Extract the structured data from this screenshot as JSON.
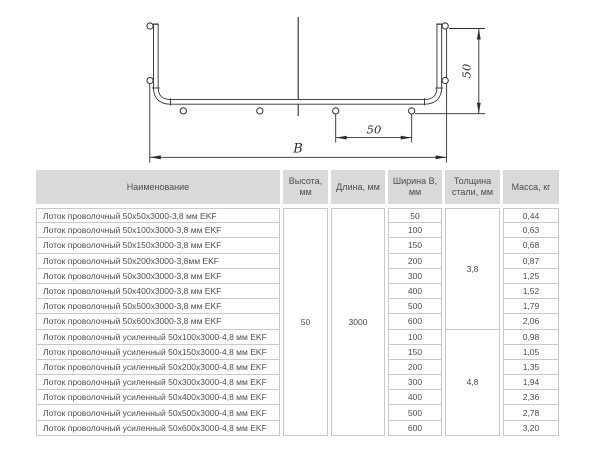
{
  "drawing": {
    "overall_width_label": "B",
    "side_height_dim": "50",
    "wire_spacing_dim": "50"
  },
  "table": {
    "headers": [
      "Наименование",
      "Высота, мм",
      "Длина, мм",
      "Ширина B, мм",
      "Толщина стали, мм",
      "Масса, кг"
    ],
    "height_mm": "50",
    "length_mm": "3000",
    "thickness_groups": [
      "3,8",
      "4,8"
    ],
    "rows": [
      {
        "name": "Лоток проволочный 50х50х3000-3,8 мм EKF",
        "width": "50",
        "mass": "0,44"
      },
      {
        "name": "Лоток проволочный 50х100х3000-3,8 мм EKF",
        "width": "100",
        "mass": "0,63"
      },
      {
        "name": "Лоток проволочный 50х150х3000-3,8 мм EKF",
        "width": "150",
        "mass": "0,68"
      },
      {
        "name": "Лоток проволочный 50х200х3000-3,8мм EKF",
        "width": "200",
        "mass": "0,87"
      },
      {
        "name": "Лоток проволочный 50х300х3000-3,8 мм EKF",
        "width": "300",
        "mass": "1,25"
      },
      {
        "name": "Лоток проволочный 50х400х3000-3,8 мм EKF",
        "width": "400",
        "mass": "1,52"
      },
      {
        "name": "Лоток проволочный 50х500х3000-3,8 мм EKF",
        "width": "500",
        "mass": "1,79"
      },
      {
        "name": "Лоток проволочный 50х600х3000-3,8 мм EKF",
        "width": "600",
        "mass": "2,06"
      },
      {
        "name": "Лоток проволочный усиленный 50х100х3000-4,8 мм EKF",
        "width": "100",
        "mass": "0,98"
      },
      {
        "name": "Лоток проволочный усиленный 50х150х3000-4,8 мм EKF",
        "width": "150",
        "mass": "1,05"
      },
      {
        "name": "Лоток проволочный усиленный 50х200х3000-4,8 мм EKF",
        "width": "200",
        "mass": "1,35"
      },
      {
        "name": "Лоток проволочный усиленный 50х300х3000-4,8 мм EKF",
        "width": "300",
        "mass": "1,94"
      },
      {
        "name": "Лоток проволочный усиленный 50х400х3000-4,8 мм EKF",
        "width": "400",
        "mass": "2,36"
      },
      {
        "name": "Лоток проволочный усиленный 50х500х3000-4,8 мм EKF",
        "width": "500",
        "mass": "2,78"
      },
      {
        "name": "Лоток проволочный усиленный 50х600х3000-4,8 мм EKF",
        "width": "600",
        "mass": "3,20"
      }
    ]
  }
}
